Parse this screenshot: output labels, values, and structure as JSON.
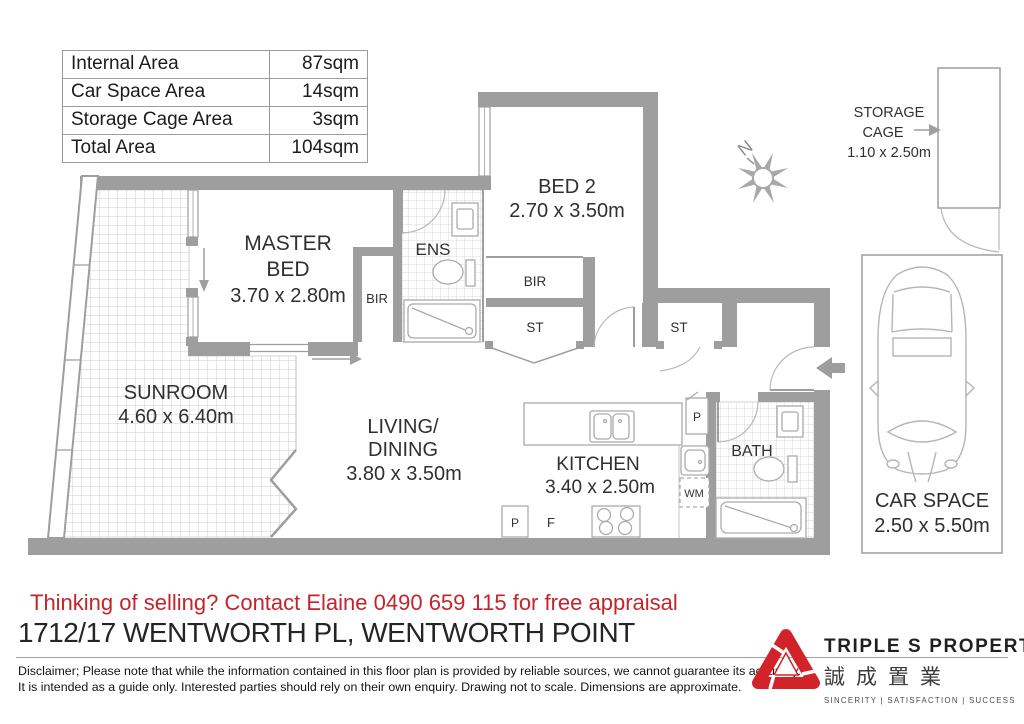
{
  "area_table": {
    "rows": [
      {
        "label": "Internal Area",
        "value": "87sqm"
      },
      {
        "label": "Car Space Area",
        "value": "14sqm"
      },
      {
        "label": "Storage Cage Area",
        "value": "3sqm"
      },
      {
        "label": "Total Area",
        "value": "104sqm"
      }
    ]
  },
  "compass": {
    "north_label": "N"
  },
  "plan": {
    "master_bed": {
      "line1": "MASTER",
      "line2": "BED",
      "dims": "3.70 x 2.80m"
    },
    "bed2": {
      "name": "BED 2",
      "dims": "2.70 x 3.50m"
    },
    "sunroom": {
      "name": "SUNROOM",
      "dims": "4.60 x 6.40m"
    },
    "living_dining": {
      "line1": "LIVING/",
      "line2": "DINING",
      "dims": "3.80 x 3.50m"
    },
    "kitchen": {
      "name": "KITCHEN",
      "dims": "3.40 x 2.50m"
    },
    "ens": {
      "name": "ENS"
    },
    "bath": {
      "name": "BATH"
    },
    "bir_master": "BIR",
    "bir_bed2": "BIR",
    "st_left": "ST",
    "st_right": "ST",
    "wm": "WM",
    "p_hall": "P",
    "p_kitchen": "P",
    "fridge": "F"
  },
  "storage_cage": {
    "line1": "STORAGE",
    "line2": "CAGE",
    "dims": "1.10 x 2.50m"
  },
  "car_space": {
    "name": "CAR SPACE",
    "dims": "2.50 x 5.50m"
  },
  "marketing_line": "Thinking of selling? Contact Elaine 0490 659 115 for free appraisal",
  "address": "1712/17 WENTWORTH PL, WENTWORTH POINT",
  "disclaimer_line1": "Disclaimer; Please note that while the information contained in this floor plan is provided by reliable sources, we cannot guarantee its accuracy.",
  "disclaimer_line2": "It is intended as a guide only. Interested parties should rely on their own enquiry. Drawing not to scale.  Dimensions are approximate.",
  "brand": {
    "name": "TRIPLE S PROPERTY",
    "chinese": "誠成置業",
    "tagline": "SINCERITY  |  SATISFACTION  |  SUCCESS"
  },
  "colors": {
    "wall": "#9e9e9e",
    "accent_red": "#c4252b",
    "logo_red": "#d2232a"
  }
}
